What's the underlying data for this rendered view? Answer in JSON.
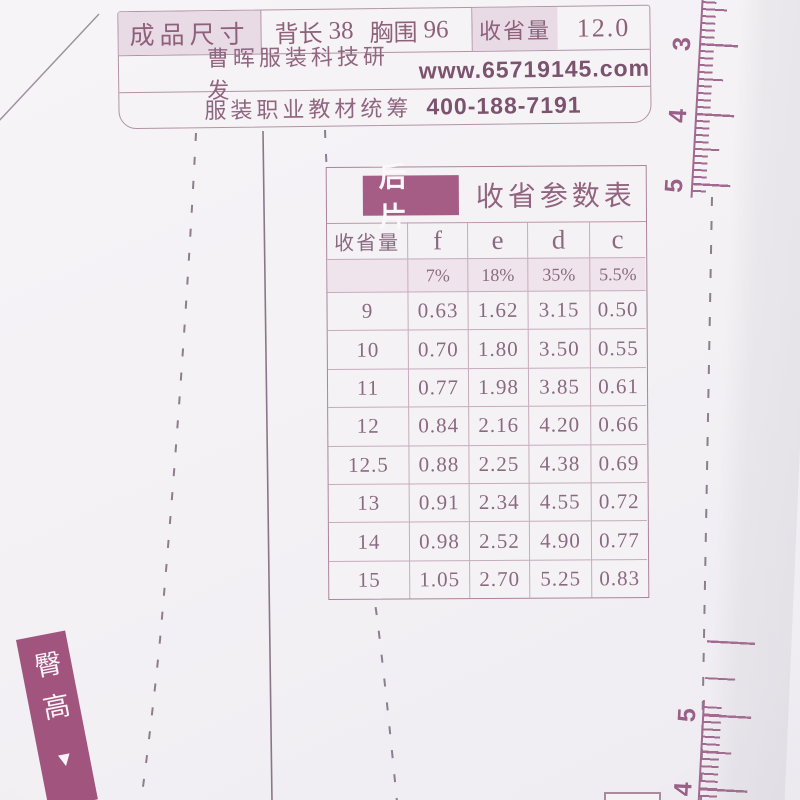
{
  "colors": {
    "accent_plum": "#a55c85",
    "hip_label_plum": "#a0547e",
    "text_plum": "#8c6480",
    "tick_plum": "#a26a90",
    "table_border": "#c6abbc",
    "cell_pink": "#e9dbe6"
  },
  "spec_bar": {
    "size_label": "成品尺寸",
    "back_length_label": "背长",
    "back_length_value": "38",
    "bust_label": "胸围",
    "bust_value": "96",
    "dart_label": "收省量",
    "dart_value": "12.0",
    "brand_name": "曹晖服装科技研发",
    "brand_site": "www.65719145.com",
    "support_name": "服装职业教材统筹",
    "support_phone": "400-188-7191"
  },
  "dart_table": {
    "piece_badge": "后片",
    "title": "收省参数表",
    "columns": [
      "收省量",
      "f",
      "e",
      "d",
      "c"
    ],
    "ratio_row": [
      "",
      "7%",
      "18%",
      "35%",
      "5.5%"
    ],
    "rows": [
      [
        "9",
        "0.63",
        "1.62",
        "3.15",
        "0.50"
      ],
      [
        "10",
        "0.70",
        "1.80",
        "3.50",
        "0.55"
      ],
      [
        "11",
        "0.77",
        "1.98",
        "3.85",
        "0.61"
      ],
      [
        "12",
        "0.84",
        "2.16",
        "4.20",
        "0.66"
      ],
      [
        "12.5",
        "0.88",
        "2.25",
        "4.38",
        "0.69"
      ],
      [
        "13",
        "0.91",
        "2.34",
        "4.55",
        "0.72"
      ],
      [
        "14",
        "0.98",
        "2.52",
        "4.90",
        "0.77"
      ],
      [
        "15",
        "1.05",
        "2.70",
        "5.25",
        "0.83"
      ]
    ]
  },
  "ruler": {
    "top_numbers": [
      "3",
      "4",
      "5"
    ],
    "bottom_numbers": [
      "5",
      "4"
    ]
  },
  "hip_label": {
    "text": "臀高",
    "arrow": "▼"
  }
}
